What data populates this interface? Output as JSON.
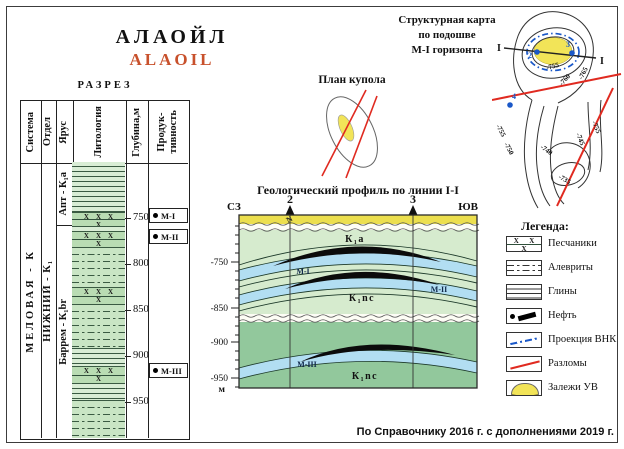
{
  "header": {
    "title_ru": "АЛАОЙЛ",
    "title_en": "ALAOIL"
  },
  "section": {
    "label": "РАЗРЕЗ",
    "col_system": "Система",
    "col_division": "Отдел",
    "col_stage": "Ярус",
    "col_lithology": "Литология",
    "col_depth": "Глубина,м",
    "col_productivity": "Продук-\nтивность",
    "system": "МЕЛОВАЯ - К",
    "division": "НИЖНИЙ - К₁",
    "stage_apt": "Апт - К₁а",
    "stage_barrem": "Баррем - К₁br",
    "depths": [
      "750",
      "800",
      "850",
      "900",
      "950"
    ],
    "markers": [
      {
        "label": "М-I"
      },
      {
        "label": "М-II"
      },
      {
        "label": "М-III"
      }
    ]
  },
  "dome": {
    "title": "План купола"
  },
  "map": {
    "title": "Структурная карта\nпо подошве\nМ-I горизонта",
    "line_start": "I",
    "line_end": "I",
    "well_2": "2",
    "well_3": "3",
    "well_4": "4",
    "contours_upper": [
      "-755",
      "-760",
      "-765"
    ],
    "contours_lower": [
      "-755",
      "-750",
      "-740",
      "-735",
      "-745",
      "-755"
    ]
  },
  "profile": {
    "title": "Геологический профиль по линии I-I",
    "dir_left": "СЗ",
    "dir_right": "ЮВ",
    "well_2": "2",
    "well_3": "3",
    "unit_n": "N",
    "unit_k1a": "К₁а",
    "unit_k1nc_upper": "К₁nc",
    "unit_k1nc_lower": "К₁nc",
    "horizon_m1": "М-I",
    "horizon_m2": "М-II",
    "horizon_m3": "М-III",
    "depths": [
      "-750",
      "-850",
      "-900",
      "-950"
    ],
    "depth_unit": "м"
  },
  "legend": {
    "title": "Легенда:",
    "items": [
      {
        "label": "Песчаники"
      },
      {
        "label": "Алевриты"
      },
      {
        "label": "Глины"
      },
      {
        "label": "Нефть"
      },
      {
        "label": "Проекция ВНК"
      },
      {
        "label": "Разломы"
      },
      {
        "label": "Залежи УВ"
      }
    ]
  },
  "footer": "По Справочнику 2016 г. с дополнениями 2019 г.",
  "colors": {
    "accent_red": "#c8512c",
    "fault_red": "#e02a20",
    "owc_blue": "#1a58c8",
    "deposit_yellow": "#f2e458",
    "horizon_blue": "#b2def2",
    "oil_black": "#111111"
  }
}
